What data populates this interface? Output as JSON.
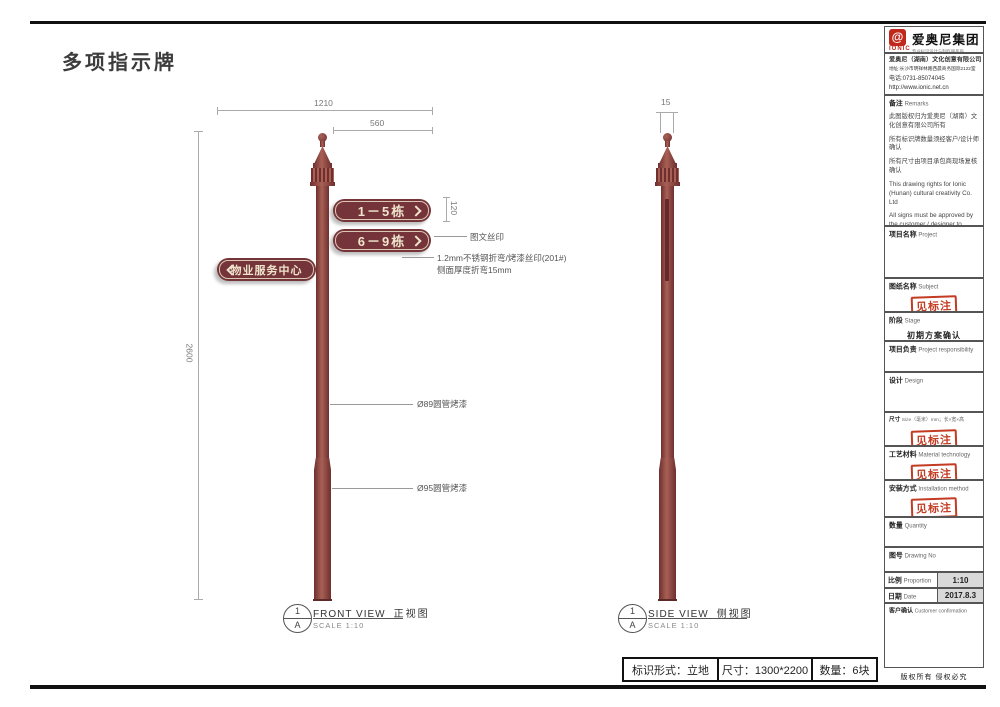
{
  "page": {
    "title": "多项指示牌",
    "copyright": "版权所有 侵权必究"
  },
  "company": {
    "logo_glyph": "@",
    "logo_label": "IONIC",
    "group_name": "爱奥尼集团",
    "tagline": "专业标识设计与制作服务商",
    "full_name": "爱奥尼（湖南）文化创意有限公司",
    "address": "地址:长沙市明祥林路西晨商务国际2122室",
    "phone": "电话:0731-85074045",
    "website": "http://www.ionic.net.cn"
  },
  "sidebar": {
    "remarks": {
      "zh": "备注",
      "en": "Remarks",
      "items_zh": [
        "此图版权归为爱奥尼（湖南）文化创意有限公司所有",
        "所有标识牌数量须经客户/设计师确认",
        "所有尺寸由项目承包商现场复核确认"
      ],
      "items_en": [
        "This drawing rights for Ionic (Hunan) cultural creativity Co. Ltd",
        "All signs must be approved by the customer / designer to confirm the number of",
        "All dimensions by the project contractors on-site review confirmed"
      ]
    },
    "project": {
      "zh": "项目名称",
      "en": "Project"
    },
    "subject": {
      "zh": "图纸名称",
      "en": "Subject",
      "stamp": "见标注"
    },
    "stage": {
      "zh": "阶段",
      "en": "Stage",
      "value": "初期方案确认"
    },
    "responsibility": {
      "zh": "项目负责",
      "en": "Project responsibility"
    },
    "design": {
      "zh": "设计",
      "en": "Design"
    },
    "size": {
      "zh": "尺寸",
      "en": "Size（毫米）mm；长×宽×高",
      "stamp": "见标注"
    },
    "material": {
      "zh": "工艺材料",
      "en": "Material technology",
      "stamp": "见标注"
    },
    "install": {
      "zh": "安装方式",
      "en": "Installation method",
      "stamp": "见标注"
    },
    "quantity": {
      "zh": "数量",
      "en": "Quantity"
    },
    "drawing_no": {
      "zh": "图号",
      "en": "Drawing No"
    },
    "proportion": {
      "zh": "比例",
      "en": "Proportion",
      "value": "1:10"
    },
    "date": {
      "zh": "日期",
      "en": "Date",
      "value": "2017.8.3"
    },
    "customer": {
      "zh": "客户确认",
      "en": "Customer confirmation"
    }
  },
  "drawing": {
    "dims": {
      "width_total": "1210",
      "width_plate": "560",
      "plate_height": "120",
      "pole_height": "2600",
      "side_thickness": "15"
    },
    "plates": [
      {
        "text": "1－5栋"
      },
      {
        "text": "6－9栋"
      },
      {
        "text": "物业服务中心"
      }
    ],
    "notes": {
      "silk": "图文丝印",
      "steel_1": "1.2mm不锈钢折弯/烤漆丝印(201#)",
      "steel_2": "侧面厚度折弯15mm",
      "pipe89": "Ø89圆管烤漆",
      "pipe95": "Ø95圆管烤漆"
    },
    "views": {
      "front": {
        "num": "1",
        "letter": "A",
        "title_en": "FRONT VIEW",
        "title_zh": "正视图",
        "scale": "SCALE 1:10"
      },
      "side": {
        "num": "1",
        "letter": "A",
        "title_en": "SIDE VIEW",
        "title_zh": "侧视图",
        "scale": "SCALE 1:10"
      }
    },
    "spec": {
      "form": "标识形式：立地",
      "size": "尺寸：1300*2200",
      "qty": "数量：6块"
    }
  }
}
